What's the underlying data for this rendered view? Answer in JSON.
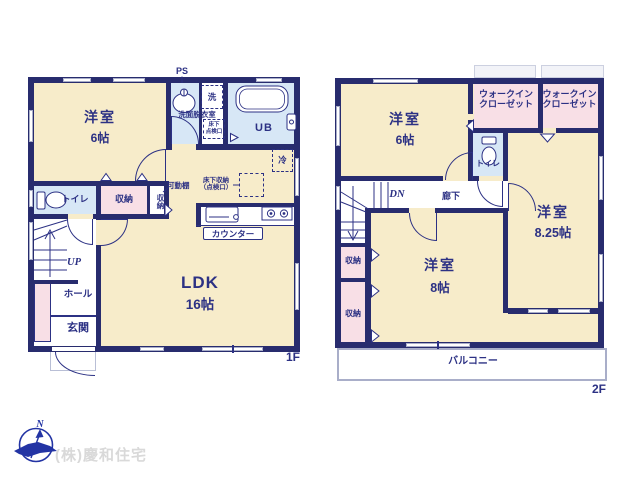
{
  "company": "(株)慶和住宅",
  "compass": {
    "north": "N"
  },
  "f1": {
    "floor_label": "1F",
    "ps": "PS",
    "washer": "洗",
    "washroom": "洗面脱衣室",
    "underfloor_hatch_l1": "床下",
    "underfloor_hatch_l2": "点検口",
    "unit_bath": "UB",
    "fridge": "冷",
    "western_name": "洋室",
    "western_size": "6帖",
    "toilet": "トイレ",
    "closet_a": "収納",
    "closet_b": "収納",
    "movable_shelf": "可動棚",
    "floor_storage_l1": "床下収納",
    "floor_storage_l2": "（点検口）",
    "counter": "カウンター",
    "ldk_name": "LDK",
    "ldk_size": "16帖",
    "up": "UP",
    "hall": "ホール",
    "entrance": "玄関"
  },
  "f2": {
    "floor_label": "2F",
    "western6_name": "洋室",
    "western6_size": "6帖",
    "wic_a_l1": "ウォークイン",
    "wic_a_l2": "クローゼット",
    "wic_b_l1": "ウォークイン",
    "wic_b_l2": "クローゼット",
    "toilet": "トイレ",
    "western825_name": "洋室",
    "western825_size": "8.25帖",
    "dn": "DN",
    "corridor": "廊下",
    "closet_a": "収納",
    "closet_b": "収納",
    "western8_name": "洋室",
    "western8_size": "8帖",
    "balcony": "バルコニー"
  }
}
